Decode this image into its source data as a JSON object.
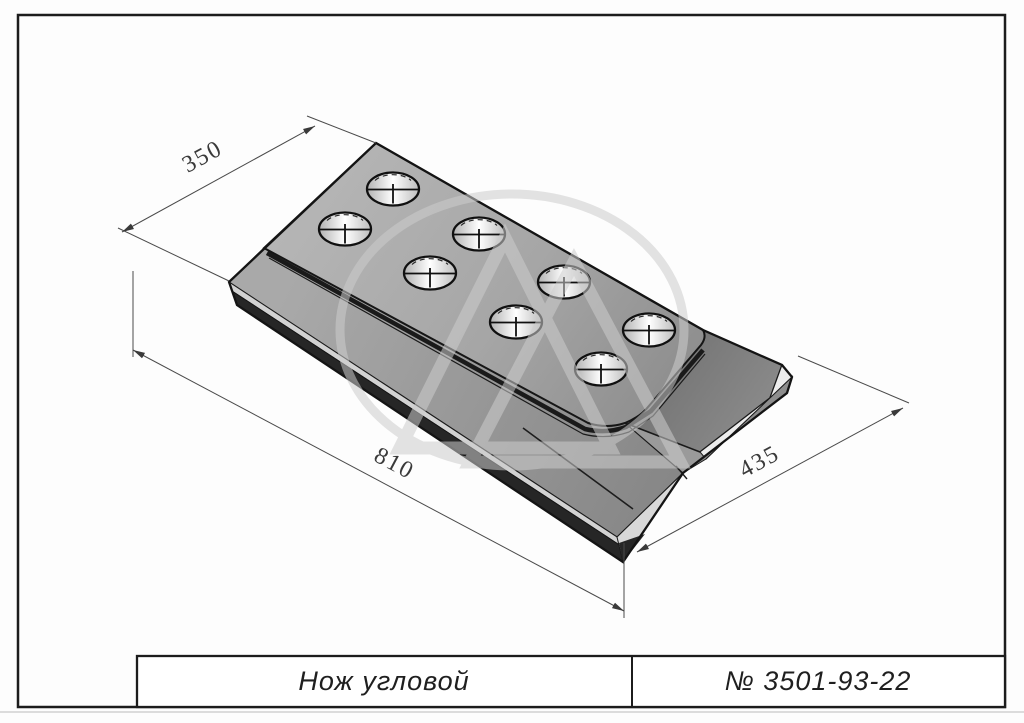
{
  "title_block": {
    "part_name": "Нож угловой",
    "part_number": "№ 3501-93-22"
  },
  "dimensions": {
    "width": "350",
    "length": "810",
    "end_length": "435"
  },
  "part": {
    "holes_count": 8,
    "view": "isometric"
  },
  "colors": {
    "background": "#ffffff",
    "line": "#1a1a1a",
    "top_face_light": "#b4b4b4",
    "top_face_dark": "#8e8e8e",
    "end_face": "#7a7a7a",
    "chamfer_strip": "#d2d2d2",
    "dark_edge": "#262626",
    "watermark": "#cdcdcd",
    "dimension_text": "#3a3a3a"
  }
}
